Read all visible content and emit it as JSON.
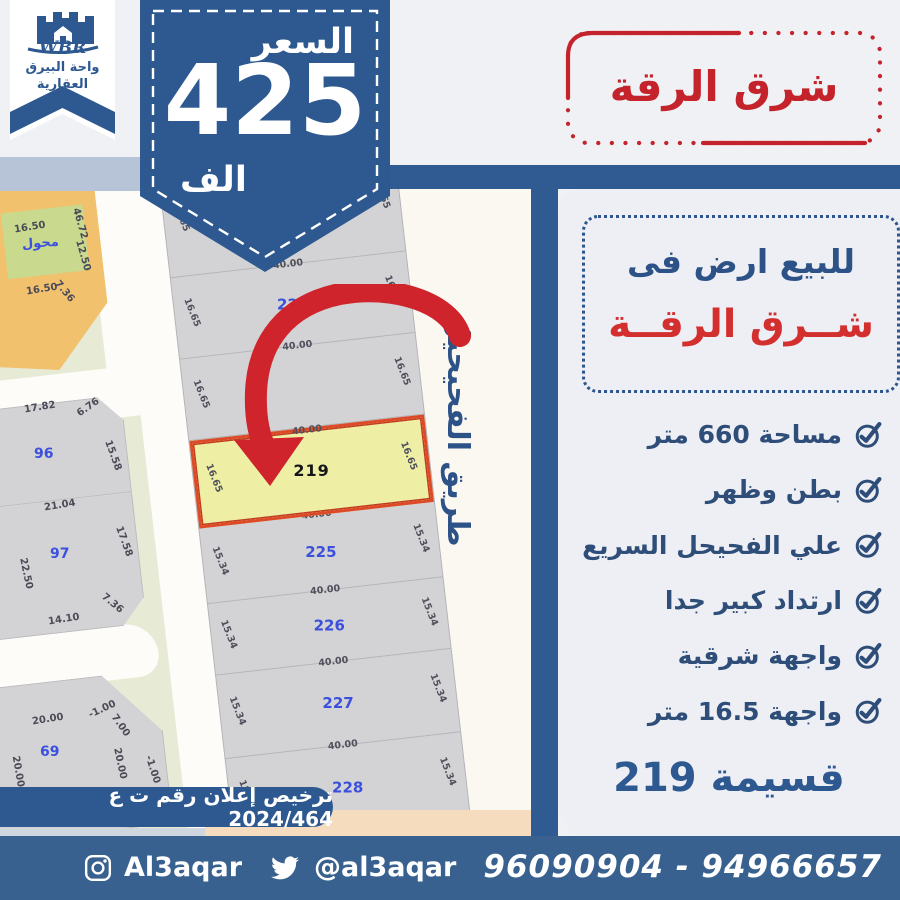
{
  "brand": {
    "wbr": "WBR",
    "org_line1": "واحة البيرق",
    "org_line2": "العقارية"
  },
  "price": {
    "label": "السعر",
    "amount": "425",
    "unit": "الف"
  },
  "stamp": {
    "text": "شرق الرقة"
  },
  "listing": {
    "title_line1": "للبيع ارض فى",
    "title_line2": "شــرق الرقــة",
    "features": [
      "مساحة 660 متر",
      "بطن وظهر",
      "علي الفحيحل السريع",
      "ارتداد كبير جدا",
      "واجهة شرقية",
      "واجهة 16.5 متر"
    ],
    "plot_caption": "قسيمة 219"
  },
  "map": {
    "road_label": "طريق الفحيحيل",
    "strip_rows": [
      {
        "id": "",
        "top": "",
        "left": "16.65",
        "right": "16.65"
      },
      {
        "id": "221",
        "top": "40.00",
        "left": "16.65",
        "right": "16.65"
      },
      {
        "id": "",
        "top": "40.00",
        "left": "16.65",
        "right": "16.65"
      },
      {
        "id": "219",
        "top": "40.00",
        "left": "16.65",
        "right": "16.65"
      },
      {
        "id": "225",
        "top": "40.00",
        "left": "15.34",
        "right": "15.34"
      },
      {
        "id": "226",
        "top": "40.00",
        "left": "15.34",
        "right": "15.34"
      },
      {
        "id": "227",
        "top": "40.00",
        "left": "15.34",
        "right": "15.34"
      },
      {
        "id": "228",
        "top": "40.00",
        "left": "15.34",
        "right": "15.34"
      }
    ],
    "labels": [
      "16.50",
      "محول",
      "16.50",
      "46.72",
      "12.50",
      "7.36",
      "17.82",
      "6.76",
      "96",
      "15.58",
      "21.04",
      "97",
      "22.50",
      "17.58",
      "14.10",
      "7.36",
      "69",
      "20.00",
      "-1.00",
      "7.00",
      "20.00",
      "-1.00",
      "20.00"
    ]
  },
  "license": {
    "text": "ترخيص إعلان رقم ت ع 2024/464"
  },
  "footer": {
    "instagram_handle": "Al3aqar",
    "twitter_handle": "@al3aqar",
    "phones": "96090904 - 94966657"
  },
  "colors": {
    "primary_blue": "#2d5990",
    "red": "#c5232b",
    "panel_bg": "#edeff4",
    "highlight_yellow": "#eeefa5",
    "highlight_border": "#dc4a28"
  }
}
